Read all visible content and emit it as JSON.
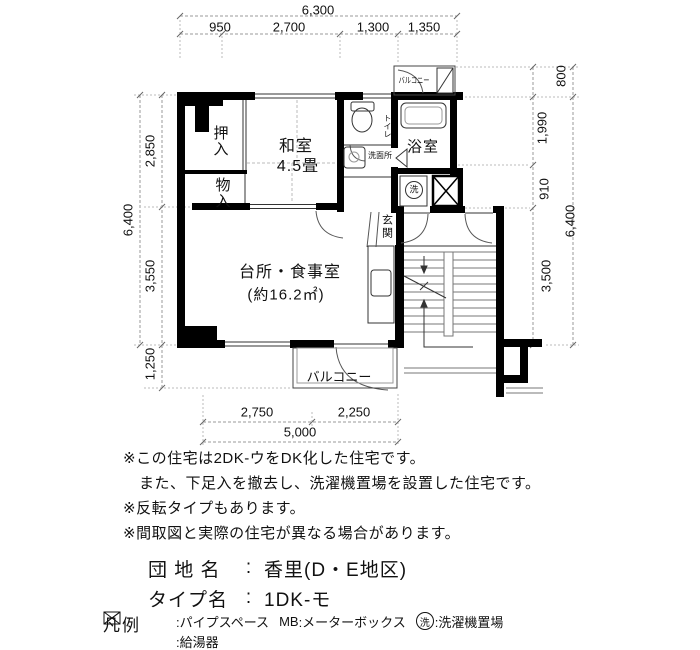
{
  "dims": {
    "top_total": "6,300",
    "top_segs": [
      "950",
      "2,700",
      "1,300",
      "1,350"
    ],
    "left_total": "6,400",
    "left_segs": [
      "2,850",
      "3,550",
      "1,250"
    ],
    "right_800": "800",
    "right_total": "6,400",
    "right_segs": [
      "1,990",
      "910",
      "3,500"
    ],
    "bottom_segs": [
      "2,750",
      "2,250"
    ],
    "bottom_total": "5,000"
  },
  "rooms": {
    "oshiire": "押入",
    "monoire": "物入",
    "washitsu": "和室",
    "washitsu_size": "4.5畳",
    "toilet": "トイレ",
    "washroom": "洗面所",
    "bath": "浴室",
    "laundry_mark": "洗",
    "genkan": "玄関",
    "dk": "台所・食事室",
    "dk_area": "(約16.2㎡)",
    "balcony_top": "バルコニー",
    "balcony_bottom": "バルコニー"
  },
  "notes": [
    "※この住宅は2DK-ウをDK化した住宅です。",
    "また、下足入を撤去し、洗濯機置場を設置した住宅です。",
    "※反転タイプもあります。",
    "※間取図と実際の住宅が異なる場合があります。"
  ],
  "info": {
    "danchi_label": "団 地 名",
    "danchi_sep": ":",
    "danchi_value": "香里(D・E地区)",
    "type_label": "タイプ名",
    "type_sep": ":",
    "type_value": "1DK-モ"
  },
  "legend": {
    "title": "凡例",
    "pipe_space": ":パイプスペース",
    "mb_label": "MB",
    "mb_value": ":メーターボックス",
    "laundry_mark": "洗",
    "laundry": ":洗濯機置場",
    "heater": ":給湯器"
  },
  "colors": {
    "wall": "#000000",
    "thin": "#333333",
    "dim": "#888888",
    "bg": "#ffffff"
  }
}
